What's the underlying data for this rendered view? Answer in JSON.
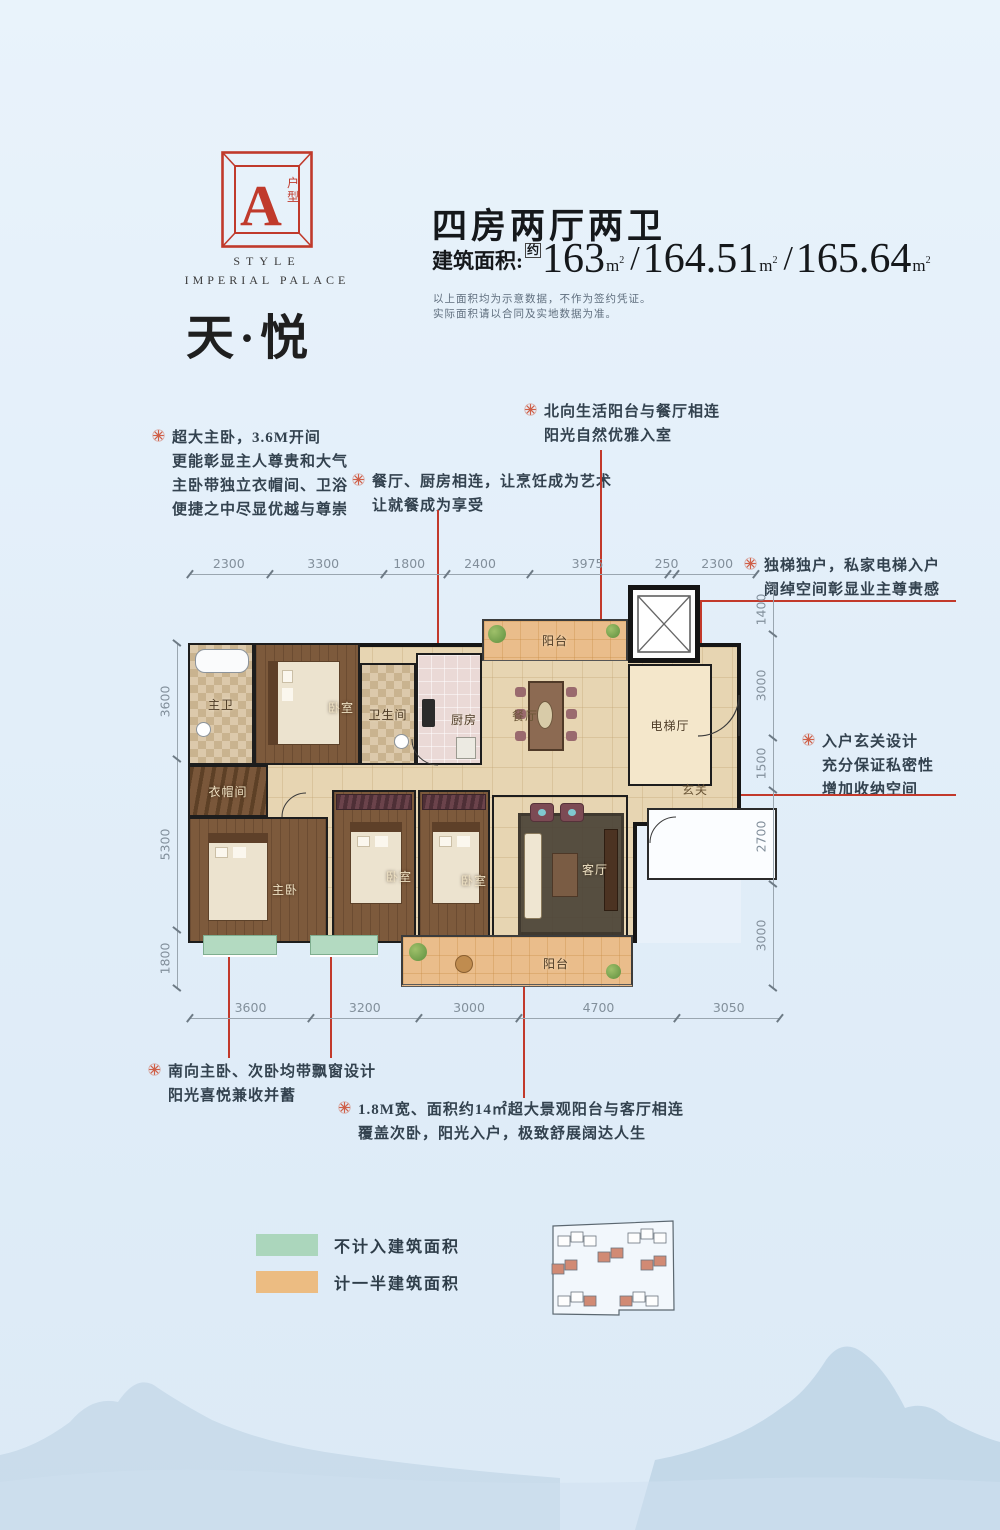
{
  "logo": {
    "letter": "A",
    "type_label_1": "户",
    "type_label_2": "型",
    "style_line1": "STYLE",
    "style_line2": "IMPERIAL PALACE",
    "accent": "#c03a2b"
  },
  "project_name": "天·悦",
  "header": {
    "title": "四房两厅两卫",
    "area_prefix": "建筑面积:",
    "area_approx": "约",
    "areas": [
      "163",
      "164.51",
      "165.64"
    ],
    "area_separator": "/",
    "area_unit_m": "m",
    "area_unit_sup": "2",
    "disclaimer_line1": "以上面积均为示意数据，不作为签约凭证。",
    "disclaimer_line2": "实际面积请以合同及实地数据为准。"
  },
  "annotations": [
    {
      "id": "master-suite",
      "lines": [
        "超大主卧，3.6M开间",
        "更能彰显主人尊贵和大气",
        "主卧带独立衣帽间、卫浴",
        "便捷之中尽显优越与尊崇"
      ]
    },
    {
      "id": "dining-kitchen",
      "lines": [
        "餐厅、厨房相连，让烹饪成为艺术",
        "让就餐成为享受"
      ]
    },
    {
      "id": "north-balcony",
      "lines": [
        "北向生活阳台与餐厅相连",
        "阳光自然优雅入室"
      ]
    },
    {
      "id": "private-elevator",
      "lines": [
        "独梯独户，私家电梯入户",
        "阔绰空间彰显业主尊贵感"
      ]
    },
    {
      "id": "foyer-design",
      "lines": [
        "入户玄关设计",
        "充分保证私密性",
        "增加收纳空间"
      ]
    },
    {
      "id": "bay-windows",
      "lines": [
        "南向主卧、次卧均带飘窗设计",
        "阳光喜悦兼收并蓄"
      ]
    },
    {
      "id": "south-balcony",
      "lines": [
        "1.8M宽、面积约14㎡超大景观阳台与客厅相连",
        "覆盖次卧，阳光入户，极致舒展阔达人生"
      ]
    }
  ],
  "floorplan": {
    "rooms": {
      "master_bath": "主卫",
      "bedroom_top": "卧室",
      "bathroom": "卫生间",
      "kitchen": "厨房",
      "balcony_north": "阳台",
      "dining": "餐厅",
      "elevator_hall": "电梯厅",
      "foyer": "玄关",
      "cloakroom": "衣帽间",
      "master_bedroom": "主卧",
      "bedroom_mid": "卧室",
      "bedroom_right": "卧室",
      "living": "客厅",
      "balcony_south": "阳台"
    },
    "dimensions": {
      "top": [
        2300,
        3300,
        1800,
        2400,
        3975,
        250,
        2300
      ],
      "bottom": [
        3600,
        3200,
        3000,
        4700,
        3050
      ],
      "left": [
        3600,
        5300,
        1800
      ],
      "right": [
        1400,
        3000,
        1500,
        2700,
        3000
      ]
    }
  },
  "legend": {
    "items": [
      {
        "label": "不计入建筑面积",
        "color": "#abd6bc"
      },
      {
        "label": "计一半建筑面积",
        "color": "#ecbc82"
      }
    ]
  },
  "sitemap": {
    "highlight": "#d18a74",
    "clusters": [
      {
        "x": 18,
        "y": 26,
        "units": [
          "w",
          "w",
          "w"
        ]
      },
      {
        "x": 88,
        "y": 23,
        "units": [
          "w",
          "w",
          "w"
        ]
      },
      {
        "x": 58,
        "y": 42,
        "units": [
          "s",
          "s"
        ]
      },
      {
        "x": 12,
        "y": 54,
        "units": [
          "s",
          "s"
        ]
      },
      {
        "x": 101,
        "y": 50,
        "units": [
          "s",
          "s"
        ]
      },
      {
        "x": 18,
        "y": 86,
        "units": [
          "w",
          "w",
          "s"
        ]
      },
      {
        "x": 80,
        "y": 86,
        "units": [
          "s",
          "w",
          "w"
        ]
      }
    ]
  }
}
